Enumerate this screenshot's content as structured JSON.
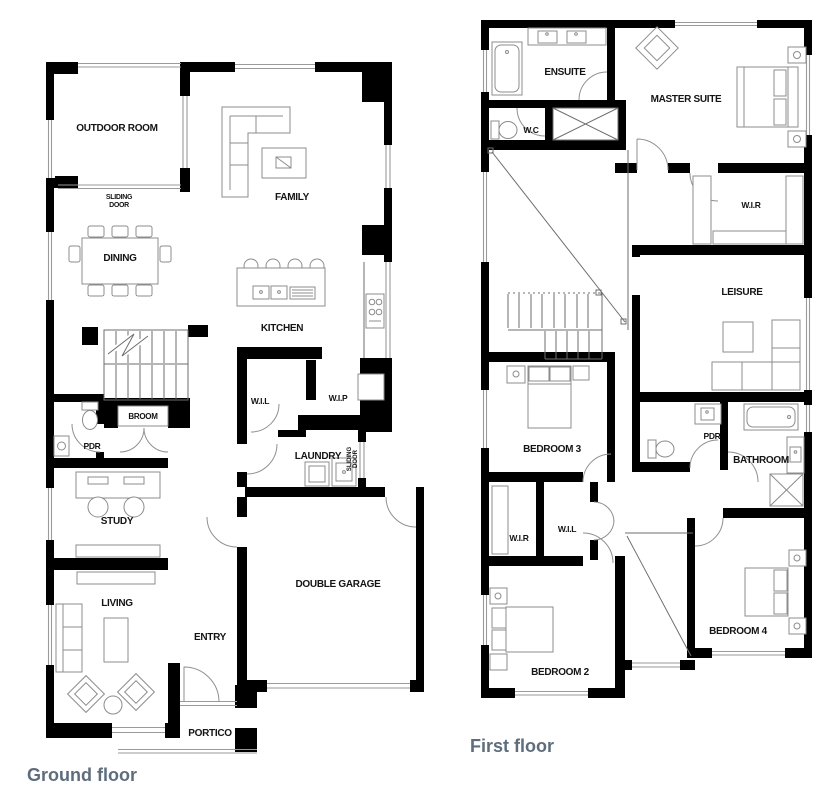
{
  "colors": {
    "background": "#ffffff",
    "wall": "#000000",
    "furniture": "#8c8c8c",
    "window": "#9a9a9a",
    "door": "#909090",
    "label_text": "#141414",
    "title_text": "#5d6d7c"
  },
  "titles": {
    "ground_floor": "Ground floor",
    "first_floor": "First floor"
  },
  "ground": {
    "rooms": {
      "outdoor_room": "OUTDOOR ROOM",
      "family": "FAMILY",
      "dining": "DINING",
      "kitchen": "KITCHEN",
      "wil": "W.I.L",
      "wip": "W.I.P",
      "broom": "BROOM",
      "pdr": "PDR",
      "laundry": "LAUNDRY",
      "study": "STUDY",
      "living": "LIVING",
      "entry": "ENTRY",
      "double_garage": "DOUBLE GARAGE",
      "portico": "PORTICO"
    },
    "annotations": {
      "sliding_door_word1": "SLIDING",
      "sliding_door_word2": "DOOR"
    }
  },
  "first": {
    "rooms": {
      "ensuite": "ENSUITE",
      "wc": "W.C",
      "master_suite": "MASTER SUITE",
      "wir_master": "W.I.R",
      "leisure": "LEISURE",
      "bedroom3": "BEDROOM 3",
      "pdr": "PDR",
      "bathroom": "BATHROOM",
      "wir": "W.I.R",
      "wil": "W.I.L",
      "bedroom2": "BEDROOM 2",
      "bedroom4": "BEDROOM 4"
    }
  }
}
